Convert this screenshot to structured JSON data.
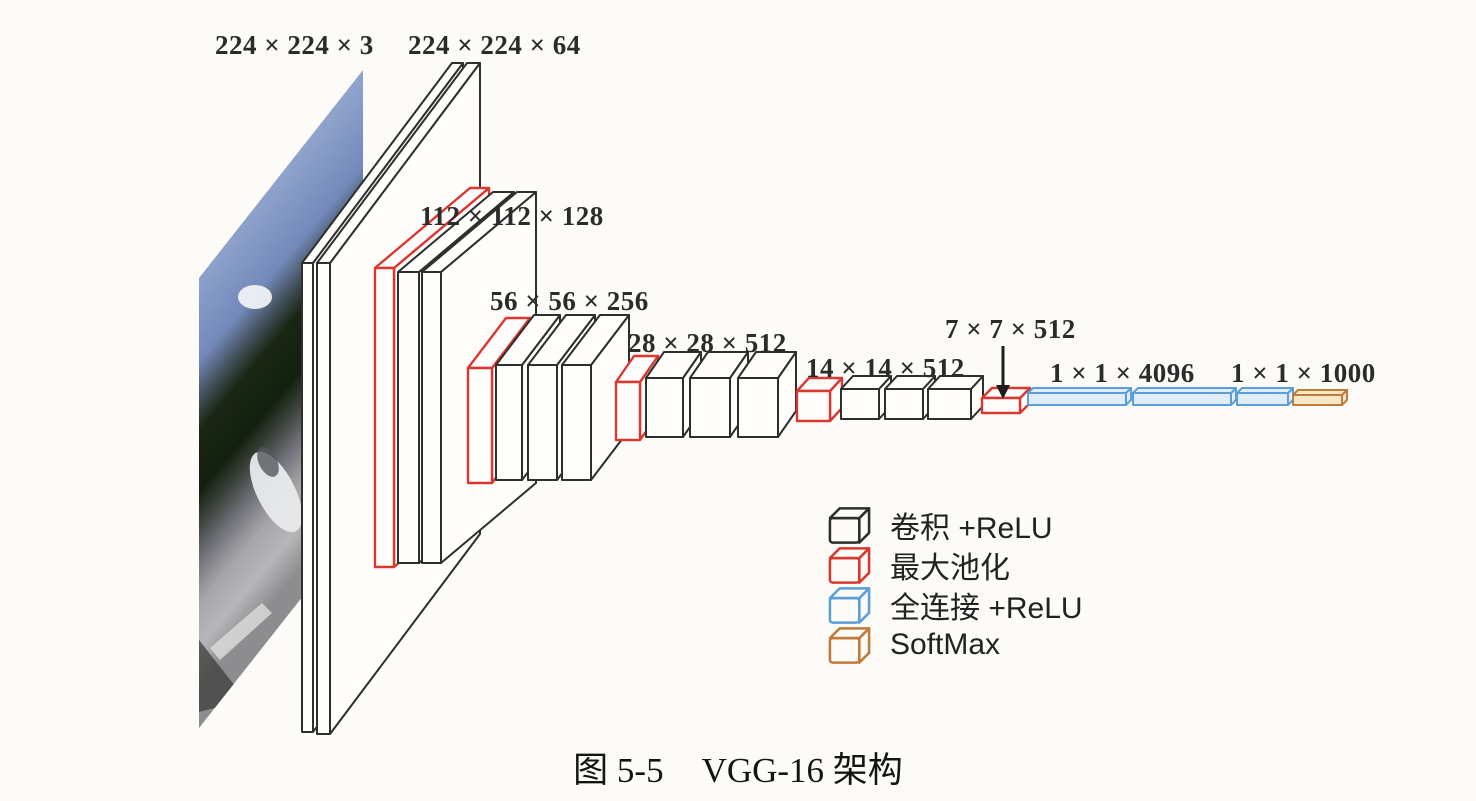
{
  "figure": {
    "caption_label": "图 5-5",
    "caption_text": "VGG-16 架构"
  },
  "diagram": {
    "network": "VGG-16",
    "dimension_labels": [
      {
        "id": "input",
        "text": "224 × 224 × 3"
      },
      {
        "id": "stage1",
        "text": "224 × 224 × 64"
      },
      {
        "id": "stage2",
        "text": "112 × 112 × 128"
      },
      {
        "id": "stage3",
        "text": "56 × 56 × 256"
      },
      {
        "id": "stage4",
        "text": "28 × 28 × 512"
      },
      {
        "id": "stage5",
        "text": "14 × 14 × 512"
      },
      {
        "id": "pool5",
        "text": "7 × 7 × 512"
      },
      {
        "id": "fc",
        "text": "1 × 1 × 4096"
      },
      {
        "id": "output",
        "text": "1 × 1 × 1000"
      }
    ],
    "legend": [
      {
        "type": "conv",
        "label": "卷积 +ReLU"
      },
      {
        "type": "pool",
        "label": "最大池化"
      },
      {
        "type": "fc",
        "label": "全连接 +ReLU"
      },
      {
        "type": "softmax",
        "label": "SoftMax"
      }
    ],
    "colors": {
      "conv": "#2e2e2e",
      "pool": "#d93831",
      "fc": "#5c9fd8",
      "softmax": "#c07a3a"
    },
    "architecture": {
      "stages": [
        {
          "output": "224×224×3",
          "blocks": [
            "input-image"
          ]
        },
        {
          "output": "224×224×64",
          "blocks": [
            "conv",
            "conv"
          ]
        },
        {
          "output": "112×112×128",
          "blocks": [
            "maxpool",
            "conv",
            "conv"
          ]
        },
        {
          "output": "56×56×256",
          "blocks": [
            "maxpool",
            "conv",
            "conv",
            "conv"
          ]
        },
        {
          "output": "28×28×512",
          "blocks": [
            "maxpool",
            "conv",
            "conv",
            "conv"
          ]
        },
        {
          "output": "14×14×512",
          "blocks": [
            "maxpool",
            "conv",
            "conv",
            "conv"
          ]
        },
        {
          "output": "7×7×512",
          "blocks": [
            "maxpool"
          ]
        },
        {
          "output": "1×1×4096",
          "blocks": [
            "fc",
            "fc"
          ]
        },
        {
          "output": "1×1×1000",
          "blocks": [
            "fc",
            "softmax"
          ]
        }
      ]
    }
  }
}
